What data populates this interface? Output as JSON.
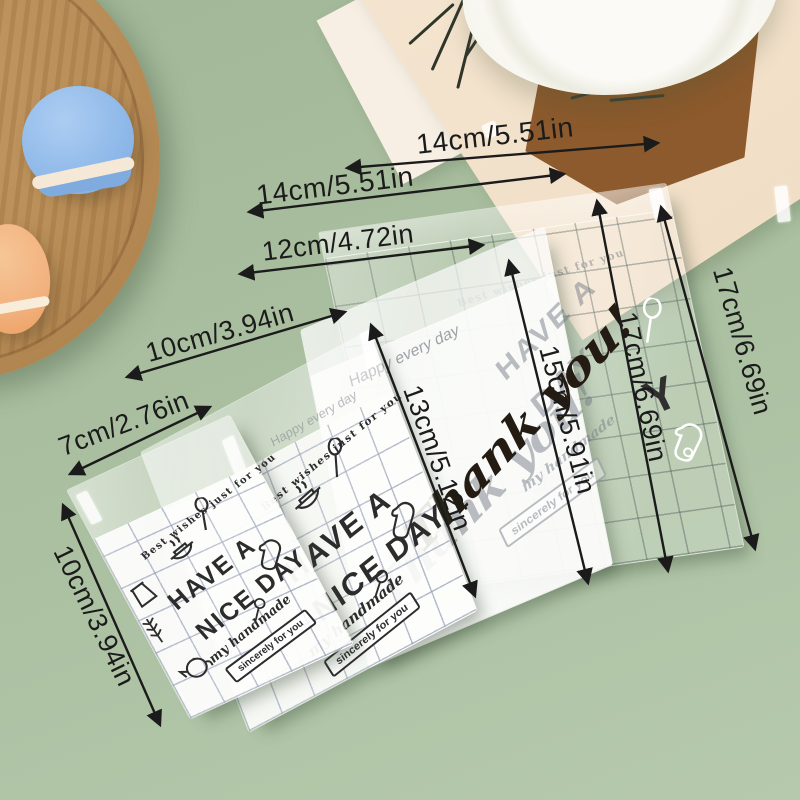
{
  "colors": {
    "background": "#a9bf9f",
    "annotation_text": "#1b1b1b",
    "bag_print_dark": "#2c2c2c",
    "grid_line_blue": "#8b95b0",
    "frosted_bag": "#f7f7f6",
    "wood_tray": "#b98e58",
    "macaron_blue": "#8fb9e9",
    "macaron_orange": "#f2b17d",
    "paper_cream": "#f2e0c9",
    "artwork_brown": "#8c5a2c",
    "plate_white": "#f9f8f3"
  },
  "annotations": {
    "widths": [
      {
        "label": "14cm/5.51in"
      },
      {
        "label": "14cm/5.51in"
      },
      {
        "label": "12cm/4.72in"
      },
      {
        "label": "10cm/3.94in"
      },
      {
        "label": "7cm/2.76in"
      }
    ],
    "heights": [
      {
        "label": "10cm/3.94in"
      },
      {
        "label": "13cm/5.12in"
      },
      {
        "label": "15cm/5.91in"
      },
      {
        "label": "17cm/6.69in"
      },
      {
        "label": "17cm/6.69in"
      }
    ]
  },
  "bags": {
    "nice_day": {
      "arch": "Best wishes just for you",
      "title_line1": "HAVE A",
      "title_line2": "NICE DAY",
      "subtitle": "my handmade",
      "box_label": "sincerely for you"
    },
    "frosted": {
      "top_text": "Happy every day",
      "script": "Thank you!",
      "ghost_line1": "HAVE A",
      "ghost_line2": "DAY",
      "ghost_subtitle": "my handmade",
      "ghost_box_label": "sincerely for you"
    },
    "grid_large": {
      "arch": "Best wishes just for you",
      "ghost_letter": "Y"
    }
  },
  "props": {
    "paper_vertical_text": "MODERNA MU"
  },
  "icons": [
    "pot-icon",
    "spoon-icon",
    "oven-mitt-icon",
    "teapot-icon",
    "jar-icon",
    "sprig-icon",
    "ladle-icon"
  ]
}
